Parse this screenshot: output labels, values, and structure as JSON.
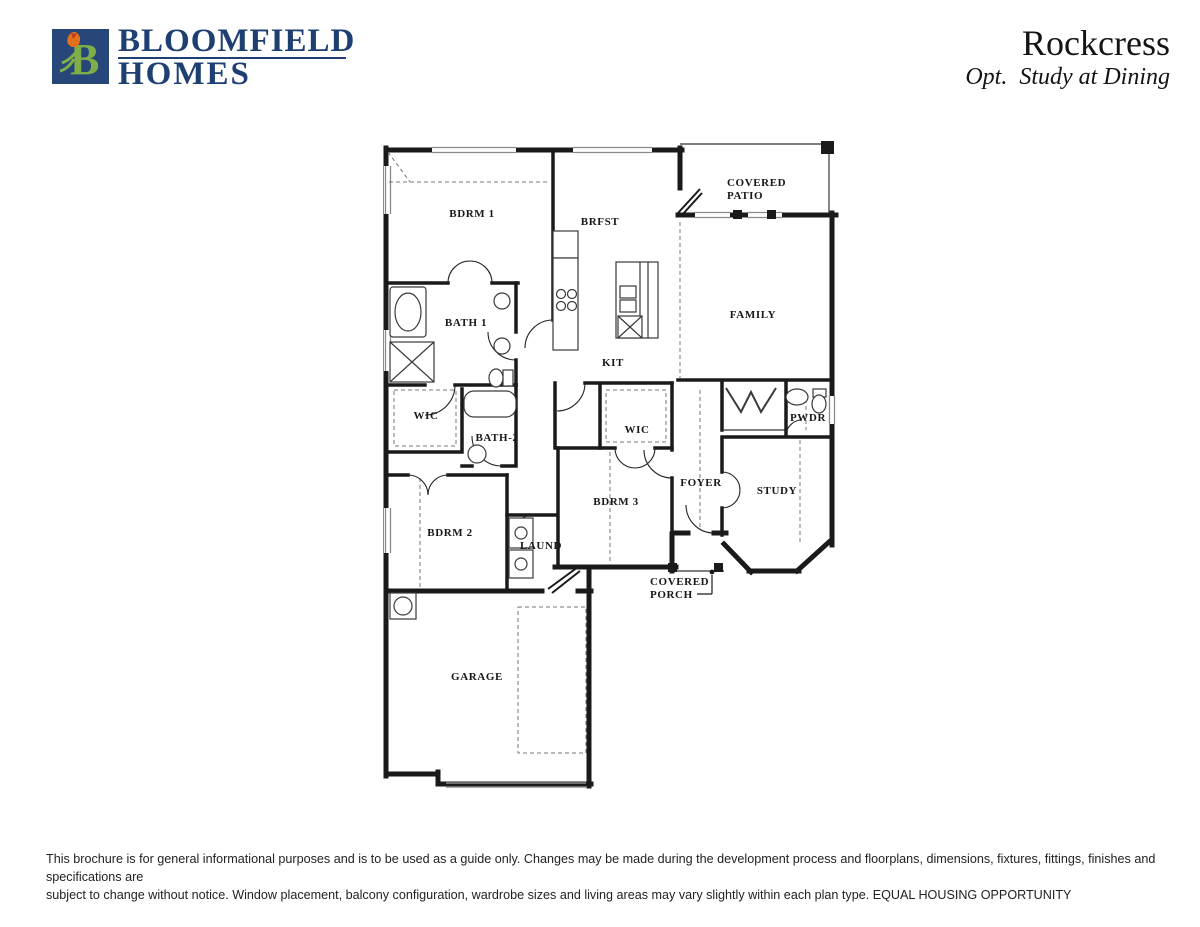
{
  "header": {
    "logo_letter": "B",
    "brand_line1": "BLOOMFIELD",
    "brand_line2": "HOMES",
    "plan_name": "Rockcress",
    "plan_option": "Opt.  Study at Dining"
  },
  "colors": {
    "brand_navy": "#1d3f72",
    "logo_green": "#7fae49",
    "logo_orange": "#e2701d",
    "wall_black": "#1a1a1a"
  },
  "floorplan": {
    "rooms": {
      "bdrm1": "BDRM 1",
      "brfst": "BRFST",
      "covered_patio_1": "COVERED",
      "covered_patio_2": "PATIO",
      "bath1": "BATH 1",
      "family": "FAMILY",
      "kit": "KIT",
      "wic_left": "WIC",
      "bath2": "BATH-2",
      "wic_bdrm3": "WIC",
      "pwdr": "PWDR",
      "bdrm3": "BDRM 3",
      "foyer": "FOYER",
      "study": "STUDY",
      "bdrm2": "BDRM 2",
      "laund": "LAUND",
      "covered_porch_1": "COVERED",
      "covered_porch_2": "PORCH",
      "garage": "GARAGE"
    }
  },
  "footer": {
    "line1": "This brochure is for general informational purposes and is to be used as a guide only. Changes may be made during the development process and floorplans, dimensions, fixtures, fittings, finishes and specifications are",
    "line2": "subject to change without notice. Window placement, balcony configuration, wardrobe sizes and living areas may vary slightly within each plan type.  EQUAL HOUSING OPPORTUNITY"
  }
}
